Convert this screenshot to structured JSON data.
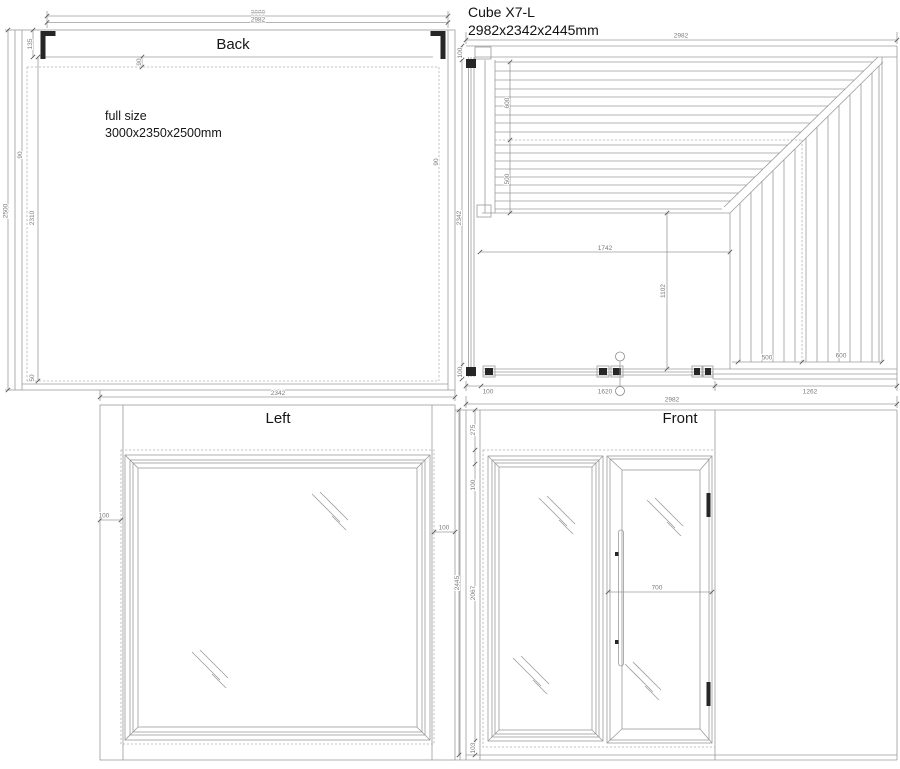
{
  "header": {
    "product": "Cube X7-L",
    "size": "2982x2342x2445mm"
  },
  "views": {
    "back": {
      "label": "Back",
      "note1": "full size",
      "note2": "3000x2350x2500mm",
      "dims": {
        "old_width": "3000",
        "width": "2982",
        "corner": "135",
        "top_inset": "90",
        "left_wall": "90",
        "right_wall": "90",
        "height": "2500",
        "inner_height": "2310",
        "bottom": "50"
      }
    },
    "plan": {
      "dims": {
        "width": "2982",
        "left_top": "100",
        "depth": "2342",
        "left_bottom": "100",
        "bench_deep": "600",
        "bench_shallow": "500",
        "interior_width": "1742",
        "interior_depth": "1102",
        "corner_bench_left": "500",
        "corner_bench_right": "600",
        "front_corner": "100",
        "front_glazing": "1620",
        "front_wall": "1262"
      }
    },
    "left": {
      "label": "Left",
      "dims": {
        "width": "2342",
        "frame_left": "100",
        "frame_right": "100"
      }
    },
    "front": {
      "label": "Front",
      "dims": {
        "width": "2982",
        "top_frame": "275",
        "glass_inset": "100",
        "opening_height": "2067",
        "bottom_frame": "103",
        "total_height": "2445",
        "door_width": "700"
      }
    }
  }
}
